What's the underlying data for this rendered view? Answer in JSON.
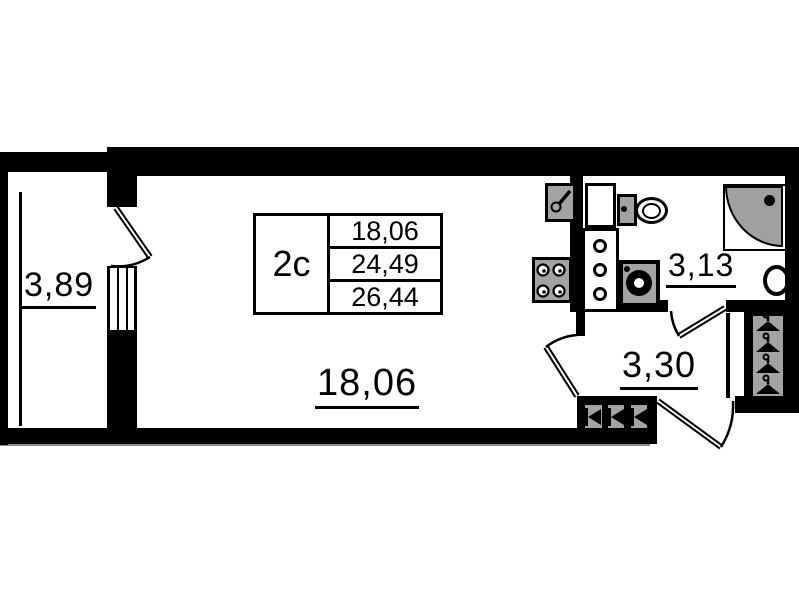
{
  "title": "studio apartment floor plan",
  "table": {
    "type_label": "2с",
    "rows": [
      "18,06",
      "24,49",
      "26,44"
    ]
  },
  "rooms": {
    "balcony": {
      "area": "3,89"
    },
    "living_room": {
      "area": "18,06"
    },
    "bathroom": {
      "area": "3,13"
    },
    "hallway": {
      "area": "3,30"
    }
  },
  "fixtures": [
    "kitchen-sink",
    "stove",
    "ventilation-shaft",
    "toilet",
    "washing-machine",
    "corner-shower",
    "wash-basin",
    "wardrobe-hangers",
    "entry-cabinet",
    "balcony-window",
    "balcony-glazing"
  ],
  "doors": [
    "balcony-door",
    "living-room-door",
    "bathroom-door",
    "entrance-door"
  ],
  "colors": {
    "wall": "#000000",
    "background": "#ffffff",
    "fixture_fill": "#a3a3a3",
    "shower_tray": "#a0a0a0"
  }
}
